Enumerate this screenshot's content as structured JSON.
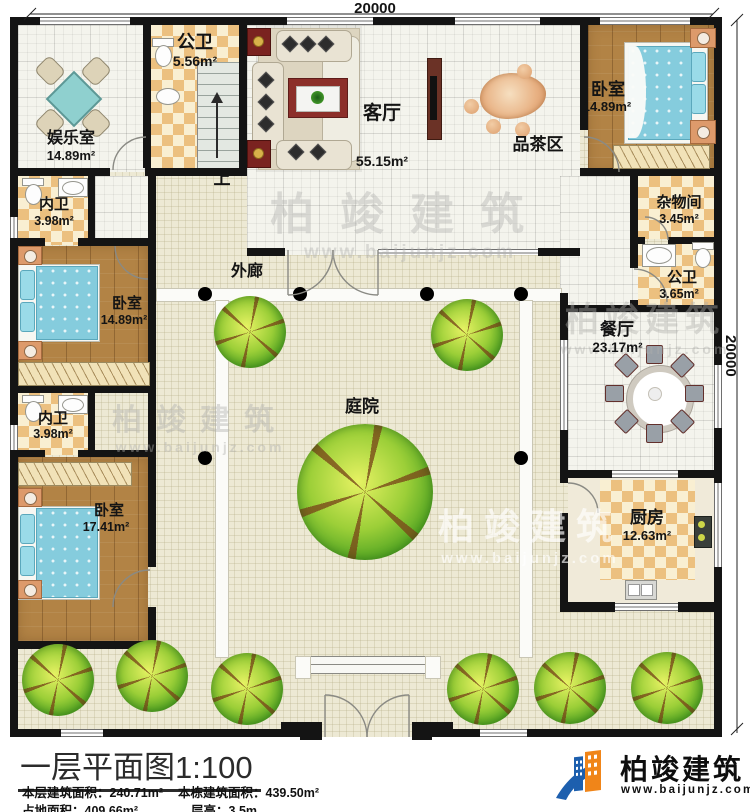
{
  "dimensions": {
    "top": "20000",
    "right": "20000"
  },
  "rooms": {
    "yule": {
      "name": "娱乐室",
      "area": "14.89m²"
    },
    "gongwei_top": {
      "name": "公卫",
      "area": "5.56m²"
    },
    "keting": {
      "name": "客厅",
      "area": "55.15m²"
    },
    "pincha": {
      "name": "品茶区"
    },
    "woshi_tr": {
      "name": "卧室",
      "area": "14.89m²"
    },
    "zawu": {
      "name": "杂物间",
      "area": "3.45m²"
    },
    "gongwei_r": {
      "name": "公卫",
      "area": "3.65m²"
    },
    "canting": {
      "name": "餐厅",
      "area": "23.17m²"
    },
    "chufang": {
      "name": "厨房",
      "area": "12.63m²"
    },
    "neiwei_1": {
      "name": "内卫",
      "area": "3.98m²"
    },
    "woshi_l1": {
      "name": "卧室",
      "area": "14.89m²"
    },
    "neiwei_2": {
      "name": "内卫",
      "area": "3.98m²"
    },
    "woshi_l2": {
      "name": "卧室",
      "area": "17.41m²"
    },
    "tingyuan": {
      "name": "庭院"
    },
    "wailang": {
      "name": "外廊"
    },
    "menlang": {
      "name": "门廊"
    }
  },
  "stairs": {
    "up_label": "上"
  },
  "title_block": {
    "title": "一层平面图",
    "scale": "1:100",
    "floor_area_label": "本层建筑面积：",
    "floor_area": "240.71m²",
    "building_area_label": "本栋建筑面积：",
    "building_area": "439.50m²",
    "land_area_label": "占地面积：",
    "land_area": "409.66m²",
    "storey_label": "层高：",
    "storey": "3.5m"
  },
  "brand": {
    "name": "柏竣建筑",
    "url": "www.baijunjz.com"
  },
  "watermark": {
    "text": "柏竣建筑",
    "url": "www.baijunjz.com"
  },
  "colors": {
    "brand_blue": "#1d5fae",
    "brand_orange": "#f08519",
    "wall": "#141414"
  }
}
